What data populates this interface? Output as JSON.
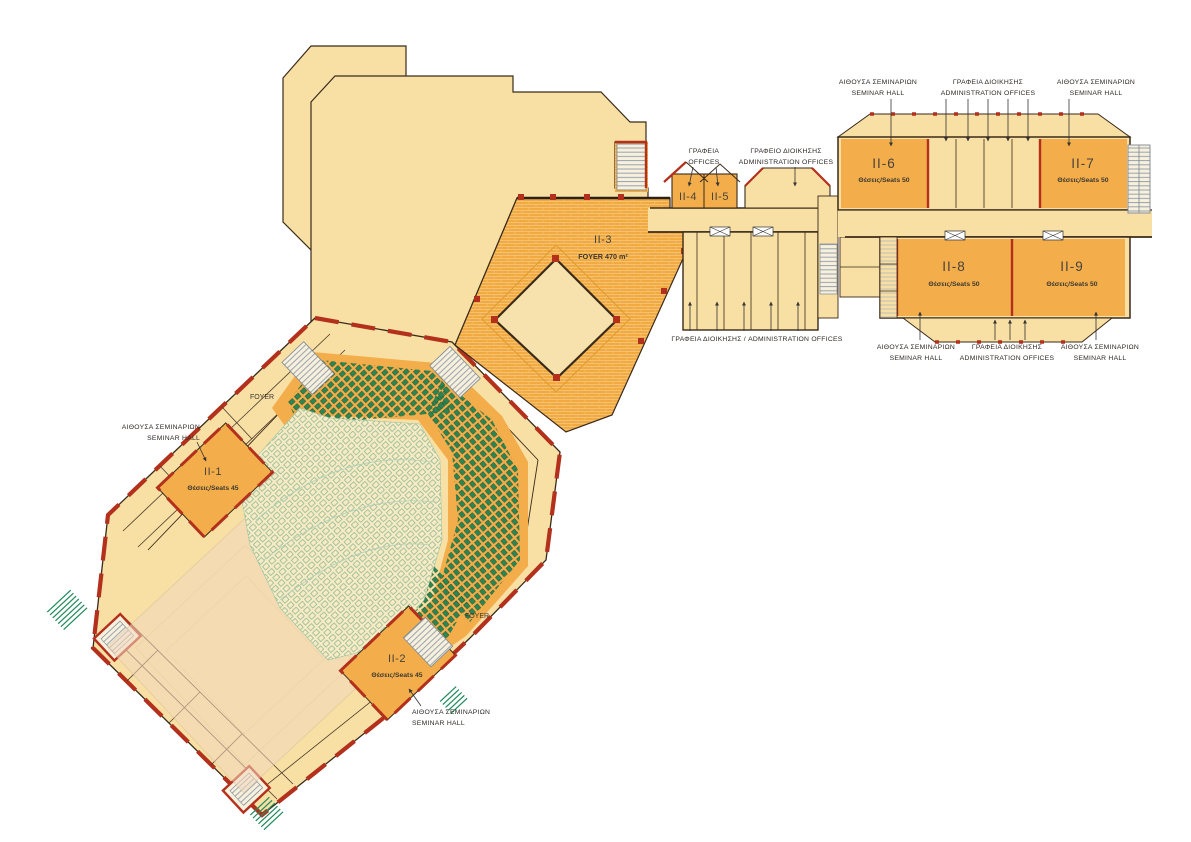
{
  "document": {
    "type": "architectural floor plan",
    "level": "II",
    "language": "Greek / English"
  },
  "colors": {
    "cream_floor": "#F8DFA4",
    "orange_room": "#F3AE4B",
    "foyer_tile": "#F1AA40",
    "wall_red": "#B2301C",
    "outline_dark": "#3A2A1A",
    "seat_green": "#2F8551",
    "seat_light_green": "#7FB591",
    "stair_gray": "#98A2AE",
    "step_green": "#1E8A5A"
  },
  "rooms": [
    {
      "id": "II-1",
      "seats": "Θέσεις/Seats 45"
    },
    {
      "id": "II-2",
      "seats": "Θέσεις/Seats 45"
    },
    {
      "id": "II-3",
      "area": "FOYER 470 m²"
    },
    {
      "id": "II-4"
    },
    {
      "id": "II-5"
    },
    {
      "id": "II-6",
      "seats": "Θέσεις/Seats 50"
    },
    {
      "id": "II-7",
      "seats": "Θέσεις/Seats 50"
    },
    {
      "id": "II-8",
      "seats": "Θέσεις/Seats 50"
    },
    {
      "id": "II-9",
      "seats": "Θέσεις/Seats 50"
    }
  ],
  "annotations": {
    "seminar_hall": {
      "gr": "ΑΙΘΟΥΣΑ ΣΕΜΙΝΑΡΙΩΝ",
      "en": "SEMINAR HALL"
    },
    "admin_offices": {
      "gr": "ΓΡΑΦΕΙΑ ΔΙΟΙΚΗΣΗΣ",
      "en": "ADMINISTRATION OFFICES"
    },
    "offices": {
      "gr": "ΓΡΑΦΕΙΑ",
      "en": "OFFICES"
    },
    "admin_office": {
      "gr": "ΓΡΑΦΕΙΟ ΔΙΟΙΚΗΣΗΣ",
      "en": "ADMINISTRATION OFFICES"
    },
    "admin_offices_inline": "ΓΡΑΦΕΙΑ ΔΙΟΙΚΗΣΗΣ / ADMINISTRATION OFFICES",
    "foyer": "FOYER"
  }
}
